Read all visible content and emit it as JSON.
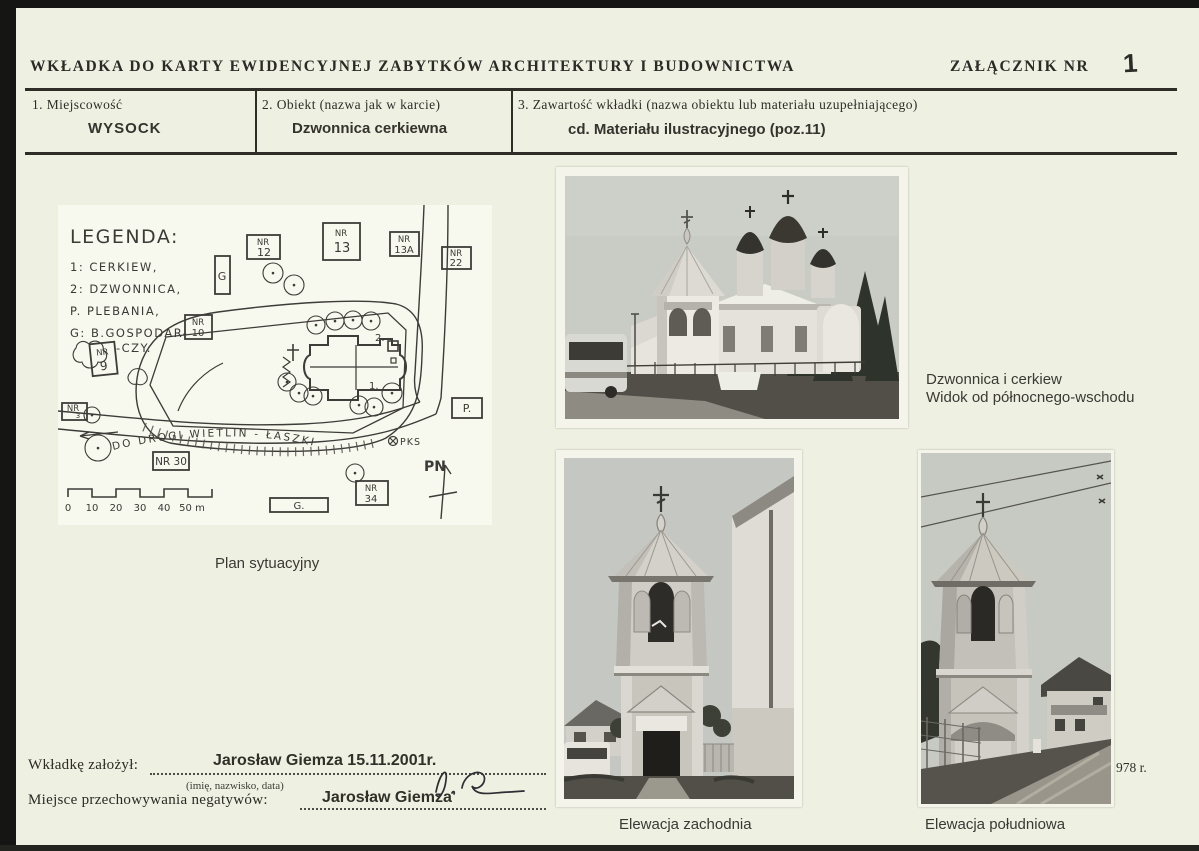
{
  "page": {
    "title": "WKŁADKA  DO  KARTY  EWIDENCYJNEJ  ZABYTKÓW  ARCHITEKTURY  I  BUDOWNICTWA",
    "attachment_label": "ZAŁĄCZNIK  NR",
    "attachment_number": "1"
  },
  "fields": [
    {
      "label": "1.  Miejscowość",
      "value": "WYSOCK"
    },
    {
      "label": "2.  Obiekt  (nazwa  jak  w  karcie)",
      "value": "Dzwonnica cerkiewna"
    },
    {
      "label": "3.  Zawartość  wkładki  (nazwa  obiektu  lub  materiału  uzupełniającego)",
      "value": "cd. Materiału ilustracyjnego (poz.11)"
    }
  ],
  "map": {
    "caption": "Plan sytuacyjny",
    "legend_title": "LEGENDA:",
    "legend": [
      "1: CERKIEW,",
      "2: DZWONNICA,",
      "P. PLEBANIA,",
      "G: B.GOSPODAR-",
      "-CZY."
    ],
    "boxes": {
      "nr12": {
        "l1": "NR",
        "l2": "12"
      },
      "nr13": {
        "l1": "NR",
        "l2": "13"
      },
      "nr13a": {
        "l1": "NR",
        "l2": "13A"
      },
      "nr22": {
        "l1": "NR",
        "l2": "22"
      },
      "nr10": {
        "l1": "NR",
        "l2": "10"
      },
      "nr9": {
        "l1": "NR",
        "l2": "9"
      },
      "nr3": {
        "l1": "NR",
        "l2": "3"
      },
      "nr30": {
        "label": "NR 30"
      },
      "nr34": {
        "l1": "NR",
        "l2": "34"
      },
      "p": {
        "label": "P."
      },
      "g": {
        "label": "G"
      },
      "g_dot": {
        "label": "G."
      }
    },
    "marks": {
      "num1": "1.",
      "num2": "2."
    },
    "road_label": "DO DROGI WIETLIN - ŁASZKI",
    "bus_stop": "PKS",
    "north": "PN",
    "scale": [
      "0",
      "10",
      "20",
      "30",
      "40",
      "50 m"
    ]
  },
  "photos": {
    "northeast": {
      "caption_line1": "Dzwonnica i cerkiew",
      "caption_line2": "Widok od północnego-wschodu"
    },
    "west": {
      "caption": "Elewacja zachodnia"
    },
    "south": {
      "caption": "Elewacja południowa",
      "date_fragment": "978 r."
    }
  },
  "footer": {
    "founder_label": "Wkładkę  założył:",
    "founder_value": "Jarosław Giemza 15.11.2001r.",
    "founder_hint": "(imię,  nazwisko,  data)",
    "negatives_label": "Miejsce  przechowywania  negatywów:",
    "negatives_value": "Jarosław Giemza"
  }
}
